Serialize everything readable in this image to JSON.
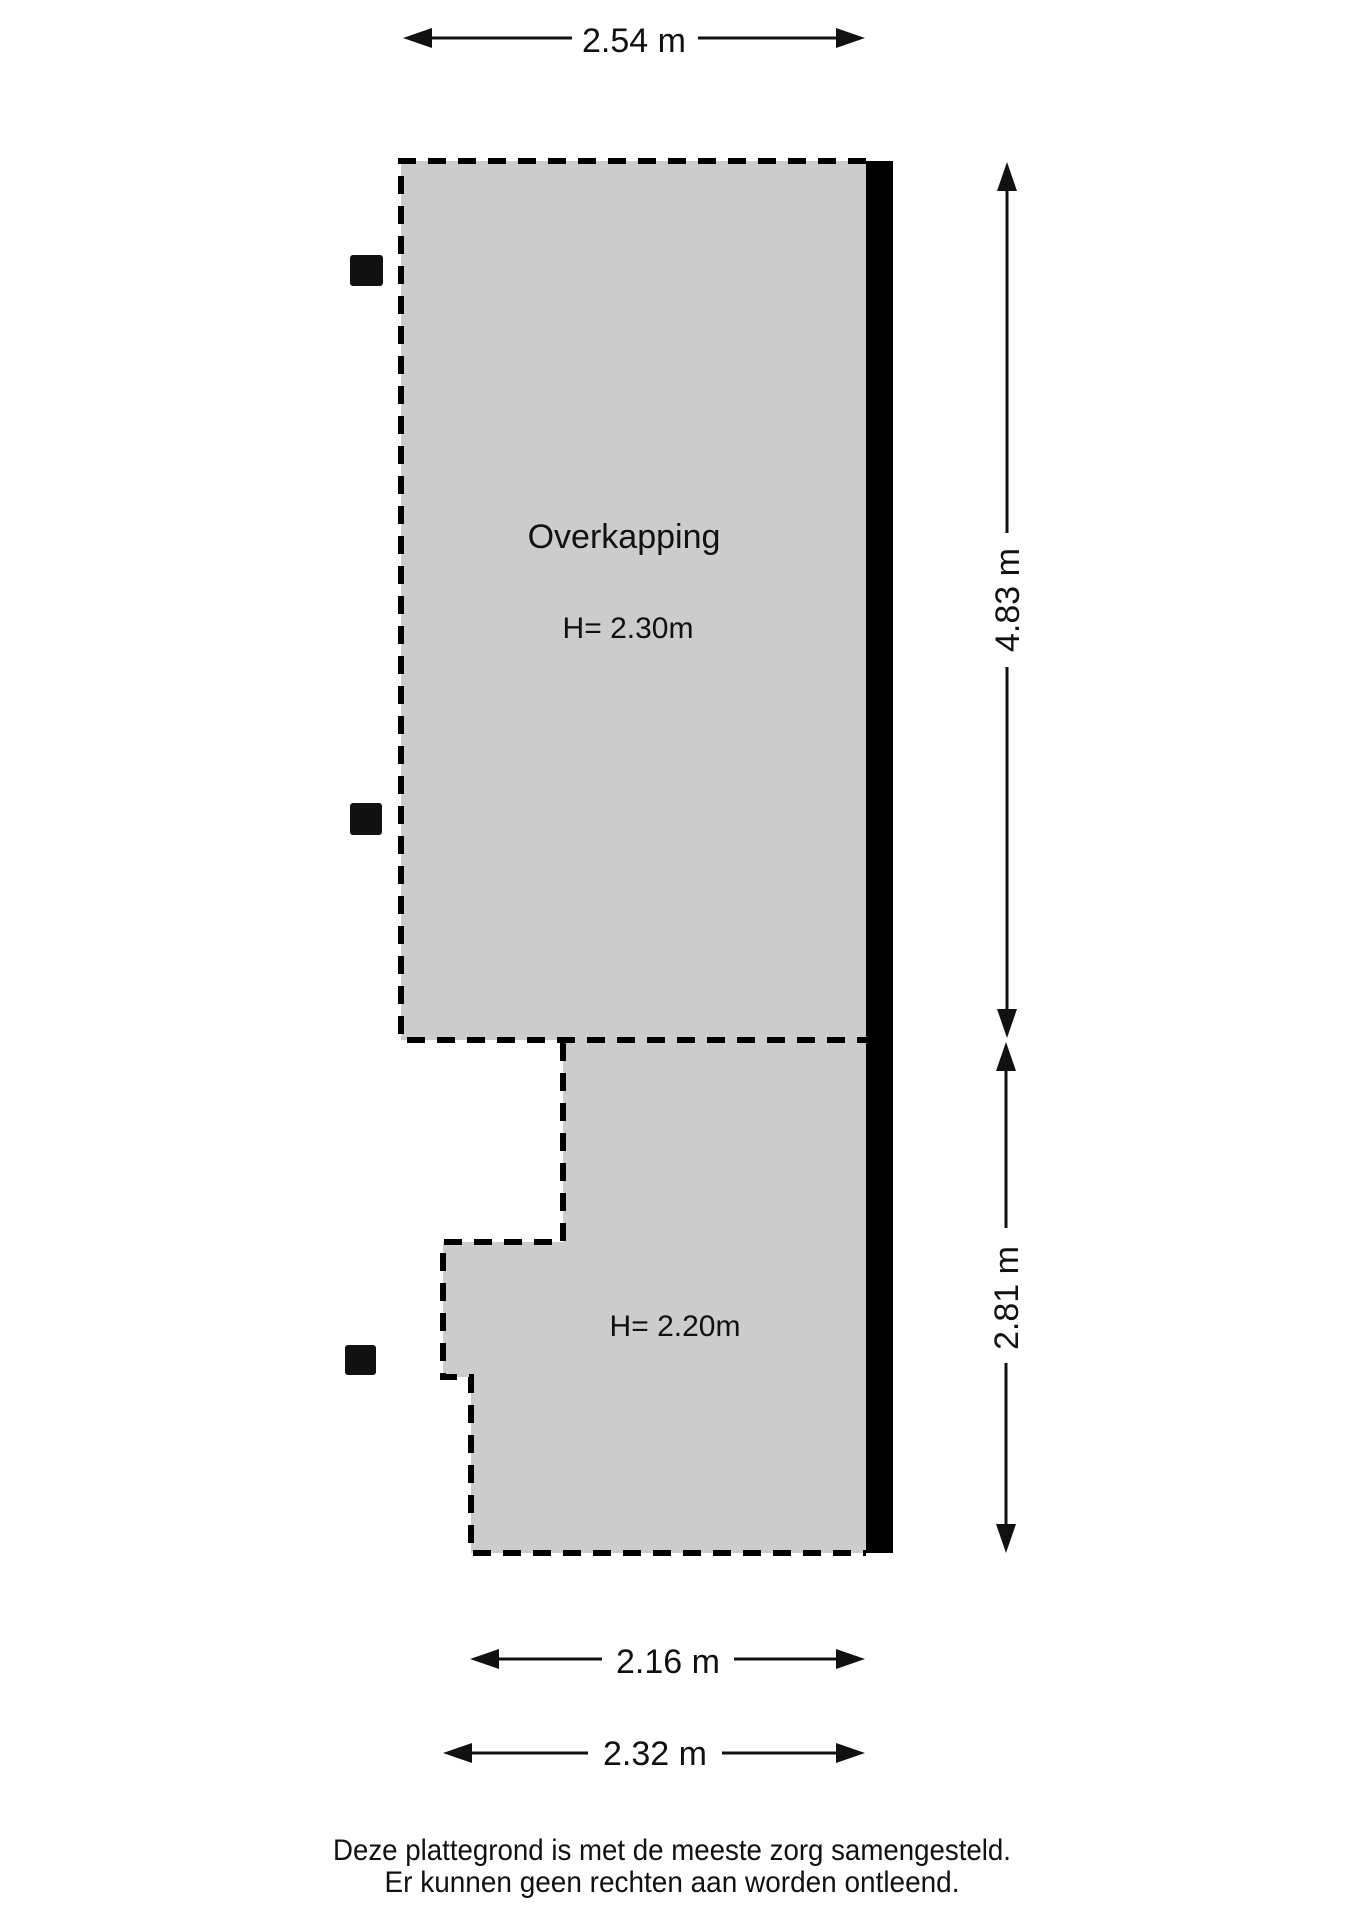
{
  "rooms": {
    "label": "Overkapping",
    "top_height": "H= 2.30m",
    "bottom_height": "H= 2.20m"
  },
  "dimensions": {
    "top_width": "2.54 m",
    "right_top": "4.83 m",
    "right_bottom": "2.81 m",
    "bottom_inner": "2.16 m",
    "bottom_outer": "2.32 m"
  },
  "footer": {
    "line1": "Deze plattegrond is met de meeste zorg samengesteld.",
    "line2": "Er kunnen geen rechten aan worden ontleend."
  },
  "colors": {
    "room_fill": "#cccccc",
    "wall_fill": "#000000",
    "line": "#000000",
    "text": "#111111"
  }
}
